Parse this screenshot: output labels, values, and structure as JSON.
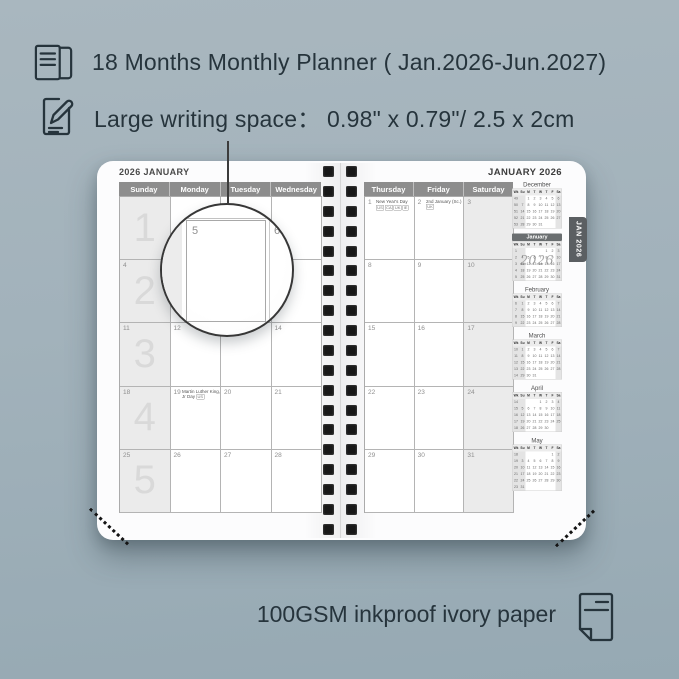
{
  "colors": {
    "background": "#a2b2bb",
    "ink": "#26343c",
    "page": "#fcfcfd",
    "weekday_header_bg": "#8d8d8d",
    "weekend_shade": "#ebebeb",
    "tab_bg": "#5b5f62",
    "binding_hole": "#181818",
    "mini_highlight_bg": "#6a6e70"
  },
  "header": {
    "line1": "18 Months Monthly Planner ( Jan.2026-Jun.2027)",
    "line2_label": "Large writing space：",
    "line2_value": "0.98\" x 0.79\"/ 2.5 x 2cm"
  },
  "footer": {
    "text": "100GSM inkproof ivory paper"
  },
  "planner": {
    "tab": "JAN 2026",
    "left_page": {
      "title": "2026 JANUARY",
      "day_headers": [
        "Sunday",
        "Monday",
        "Tuesday",
        "Wednesday"
      ],
      "rows": [
        {
          "watermark": "1",
          "dates": [
            "",
            "",
            "",
            ""
          ]
        },
        {
          "watermark": "2",
          "dates": [
            "4",
            "5",
            "6",
            "7"
          ]
        },
        {
          "watermark": "3",
          "dates": [
            "11",
            "12",
            "13",
            "14"
          ]
        },
        {
          "watermark": "4",
          "dates": [
            "18",
            "19",
            "20",
            "21"
          ]
        },
        {
          "watermark": "5",
          "dates": [
            "25",
            "26",
            "27",
            "28"
          ]
        }
      ],
      "holidays": [
        {
          "row": 3,
          "col": 1,
          "name": "Martin Luther King, Jr Day",
          "tags": [
            "US"
          ],
          "tags_below": false
        }
      ]
    },
    "right_page": {
      "title": "JANUARY 2026",
      "day_headers": [
        "Thursday",
        "Friday",
        "Saturday"
      ],
      "rows": [
        {
          "dates": [
            "1",
            "2",
            "3"
          ]
        },
        {
          "dates": [
            "8",
            "9",
            "10"
          ]
        },
        {
          "dates": [
            "15",
            "16",
            "17"
          ]
        },
        {
          "dates": [
            "22",
            "23",
            "24"
          ]
        },
        {
          "dates": [
            "29",
            "30",
            "31"
          ]
        }
      ],
      "holidays": [
        {
          "row": 0,
          "col": 0,
          "name": "New Year's Day",
          "tags": [
            "US",
            "CA",
            "UK",
            "IE"
          ],
          "tags_below": true
        },
        {
          "row": 0,
          "col": 1,
          "name": "2nd January (Sc.)",
          "tags": [
            "UK"
          ],
          "tags_below": false
        }
      ]
    },
    "magnifier": {
      "date": "5",
      "next_date": "6"
    },
    "binding_hole_rows": 19,
    "mini_calendars": {
      "header": [
        "Wk",
        "Su",
        "M",
        "T",
        "W",
        "T",
        "F",
        "Sa"
      ],
      "year_watermark": "2026",
      "months": [
        {
          "name": "December",
          "highlight": false,
          "weeks": [
            [
              "49",
              "",
              "1",
              "2",
              "3",
              "4",
              "5",
              "6"
            ],
            [
              "50",
              "7",
              "8",
              "9",
              "10",
              "11",
              "12",
              "13"
            ],
            [
              "51",
              "14",
              "15",
              "16",
              "17",
              "18",
              "19",
              "20"
            ],
            [
              "52",
              "21",
              "22",
              "23",
              "24",
              "25",
              "26",
              "27"
            ],
            [
              "53",
              "28",
              "29",
              "30",
              "31",
              "",
              "",
              ""
            ]
          ]
        },
        {
          "name": "January",
          "highlight": true,
          "weeks": [
            [
              "1",
              "",
              "",
              "",
              "",
              "1",
              "2",
              "3"
            ],
            [
              "2",
              "4",
              "5",
              "6",
              "7",
              "8",
              "9",
              "10"
            ],
            [
              "3",
              "11",
              "12",
              "13",
              "14",
              "15",
              "16",
              "17"
            ],
            [
              "4",
              "18",
              "19",
              "20",
              "21",
              "22",
              "23",
              "24"
            ],
            [
              "5",
              "25",
              "26",
              "27",
              "28",
              "29",
              "30",
              "31"
            ]
          ]
        },
        {
          "name": "February",
          "highlight": false,
          "weeks": [
            [
              "6",
              "1",
              "2",
              "3",
              "4",
              "5",
              "6",
              "7"
            ],
            [
              "7",
              "8",
              "9",
              "10",
              "11",
              "12",
              "13",
              "14"
            ],
            [
              "8",
              "15",
              "16",
              "17",
              "18",
              "19",
              "20",
              "21"
            ],
            [
              "9",
              "22",
              "23",
              "24",
              "25",
              "26",
              "27",
              "28"
            ]
          ]
        },
        {
          "name": "March",
          "highlight": false,
          "weeks": [
            [
              "10",
              "1",
              "2",
              "3",
              "4",
              "5",
              "6",
              "7"
            ],
            [
              "11",
              "8",
              "9",
              "10",
              "11",
              "12",
              "13",
              "14"
            ],
            [
              "12",
              "15",
              "16",
              "17",
              "18",
              "19",
              "20",
              "21"
            ],
            [
              "13",
              "22",
              "23",
              "24",
              "25",
              "26",
              "27",
              "28"
            ],
            [
              "14",
              "29",
              "30",
              "31",
              "",
              "",
              "",
              ""
            ]
          ]
        },
        {
          "name": "April",
          "highlight": false,
          "weeks": [
            [
              "14",
              "",
              "",
              "",
              "1",
              "2",
              "3",
              "4"
            ],
            [
              "15",
              "5",
              "6",
              "7",
              "8",
              "9",
              "10",
              "11"
            ],
            [
              "16",
              "12",
              "13",
              "14",
              "15",
              "16",
              "17",
              "18"
            ],
            [
              "17",
              "19",
              "20",
              "21",
              "22",
              "23",
              "24",
              "25"
            ],
            [
              "18",
              "26",
              "27",
              "28",
              "29",
              "30",
              "",
              ""
            ]
          ]
        },
        {
          "name": "May",
          "highlight": false,
          "weeks": [
            [
              "18",
              "",
              "",
              "",
              "",
              "",
              "1",
              "2"
            ],
            [
              "19",
              "3",
              "4",
              "5",
              "6",
              "7",
              "8",
              "9"
            ],
            [
              "20",
              "10",
              "11",
              "12",
              "13",
              "14",
              "15",
              "16"
            ],
            [
              "21",
              "17",
              "18",
              "19",
              "20",
              "21",
              "22",
              "23"
            ],
            [
              "22",
              "24",
              "25",
              "26",
              "27",
              "28",
              "29",
              "30"
            ],
            [
              "23",
              "31",
              "",
              "",
              "",
              "",
              "",
              ""
            ]
          ]
        }
      ]
    }
  }
}
